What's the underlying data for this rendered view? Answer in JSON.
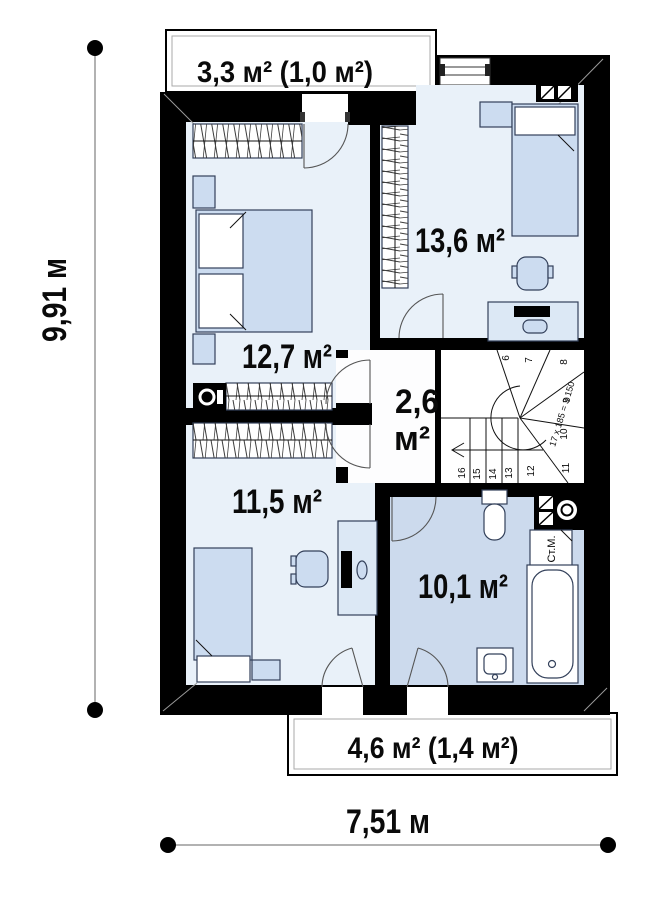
{
  "plan": {
    "rooms": [
      {
        "name": "bedroom-upper-left",
        "area_label": "12,7 м²"
      },
      {
        "name": "bedroom-upper-right",
        "area_label": "13,6 м²"
      },
      {
        "name": "hall",
        "area_label_line1": "2,6",
        "area_label_line2": "м²"
      },
      {
        "name": "bedroom-lower-left",
        "area_label": "11,5 м²"
      },
      {
        "name": "bathroom",
        "area_label": "10,1 м²"
      }
    ],
    "balconies": [
      {
        "name": "balcony-top",
        "area_label": "3,3 м² (1,0 м²)"
      },
      {
        "name": "balcony-bottom",
        "area_label": "4,6 м² (1,4 м²)"
      }
    ],
    "stairs": {
      "step_numbers": [
        "6",
        "7",
        "8",
        "9",
        "10",
        "11",
        "12",
        "13",
        "14",
        "15",
        "16"
      ],
      "formula": "17 x 185 = 3 150"
    },
    "appliance_labels": {
      "washing_machine": "Ст.М."
    },
    "dimensions": {
      "height_label": "9,91 м",
      "width_label": "7,51 м"
    },
    "icons": {
      "ventilation_grille": "two hatched squares",
      "boiler": "hatched squares with burner circle",
      "media_unit": "black box with disc"
    },
    "colors": {
      "wall": "#000000",
      "room_fill": "#e9f1f9",
      "bathroom_fill": "#ccdaed",
      "hall_fill": "#fdfdfe",
      "furniture_fill": "#ccdcf0",
      "desk_fill": "#dce8f5",
      "outline": "#33405a"
    }
  }
}
